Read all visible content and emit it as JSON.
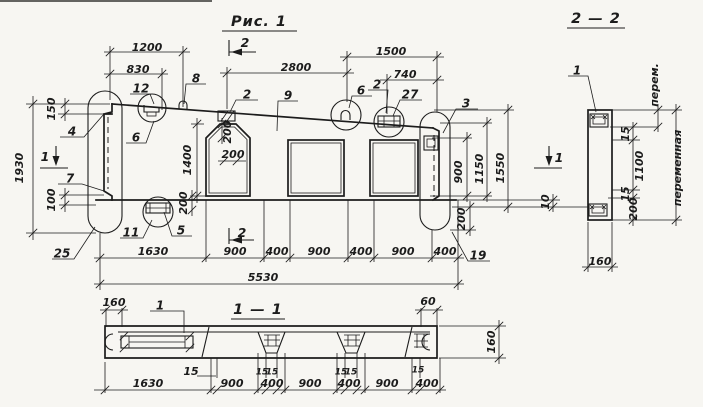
{
  "colors": {
    "paper": "#f7f6f2",
    "ink": "#1c1c1c"
  },
  "titles": {
    "figure": "Рис. 1",
    "section_2_2": "2 — 2",
    "section_1_1": "1 — 1"
  },
  "markers": {
    "cut_2_top": "2",
    "cut_2_bottom": "2",
    "cut_1_left": "1",
    "cut_1_right": "1"
  },
  "labels": [
    {
      "name": "dim-1200",
      "text": "1200",
      "x": 147,
      "y": 48,
      "rot": 0,
      "kind": "dim"
    },
    {
      "name": "dim-830",
      "text": "830",
      "x": 138,
      "y": 70,
      "rot": 0,
      "kind": "dim"
    },
    {
      "name": "callout-12",
      "text": "12",
      "x": 141,
      "y": 89,
      "rot": 0,
      "kind": "callout"
    },
    {
      "name": "callout-8",
      "text": "8",
      "x": 196,
      "y": 79,
      "rot": 0,
      "kind": "callout"
    },
    {
      "name": "dim-2800",
      "text": "2800",
      "x": 296,
      "y": 68,
      "rot": 0,
      "kind": "dim"
    },
    {
      "name": "dim-1500",
      "text": "1500",
      "x": 391,
      "y": 52,
      "rot": 0,
      "kind": "dim"
    },
    {
      "name": "dim-740",
      "text": "740",
      "x": 405,
      "y": 75,
      "rot": 0,
      "kind": "dim"
    },
    {
      "name": "callout-2-center",
      "text": "2",
      "x": 247,
      "y": 95,
      "rot": 0,
      "kind": "callout"
    },
    {
      "name": "callout-9",
      "text": "9",
      "x": 288,
      "y": 96,
      "rot": 0,
      "kind": "callout"
    },
    {
      "name": "callout-6-right",
      "text": "6",
      "x": 361,
      "y": 91,
      "rot": 0,
      "kind": "callout"
    },
    {
      "name": "callout-2-right",
      "text": "2",
      "x": 377,
      "y": 85,
      "rot": 0,
      "kind": "callout"
    },
    {
      "name": "callout-27",
      "text": "27",
      "x": 410,
      "y": 95,
      "rot": 0,
      "kind": "callout"
    },
    {
      "name": "callout-3",
      "text": "3",
      "x": 466,
      "y": 104,
      "rot": 0,
      "kind": "callout"
    },
    {
      "name": "callout-4",
      "text": "4",
      "x": 72,
      "y": 132,
      "rot": 0,
      "kind": "callout"
    },
    {
      "name": "callout-6-left",
      "text": "6",
      "x": 136,
      "y": 138,
      "rot": 0,
      "kind": "callout"
    },
    {
      "name": "callout-7",
      "text": "7",
      "x": 70,
      "y": 179,
      "rot": 0,
      "kind": "callout"
    },
    {
      "name": "callout-11",
      "text": "11",
      "x": 131,
      "y": 233,
      "rot": 0,
      "kind": "callout"
    },
    {
      "name": "callout-5",
      "text": "5",
      "x": 181,
      "y": 231,
      "rot": 0,
      "kind": "callout"
    },
    {
      "name": "callout-25",
      "text": "25",
      "x": 62,
      "y": 254,
      "rot": 0,
      "kind": "callout"
    },
    {
      "name": "callout-19",
      "text": "19",
      "x": 478,
      "y": 256,
      "rot": 0,
      "kind": "callout"
    },
    {
      "name": "dim-1930",
      "text": "1930",
      "x": 20,
      "y": 168,
      "rot": -90,
      "kind": "dim"
    },
    {
      "name": "dim-150",
      "text": "150",
      "x": 52,
      "y": 109,
      "rot": -90,
      "kind": "dim"
    },
    {
      "name": "dim-100",
      "text": "100",
      "x": 52,
      "y": 200,
      "rot": -90,
      "kind": "dim"
    },
    {
      "name": "dim-1400",
      "text": "1400",
      "x": 188,
      "y": 160,
      "rot": -90,
      "kind": "dim"
    },
    {
      "name": "dim-200-chamfer-v",
      "text": "200",
      "x": 228,
      "y": 132,
      "rot": -90,
      "kind": "dim"
    },
    {
      "name": "dim-200-chamfer-h",
      "text": "200",
      "x": 233,
      "y": 155,
      "rot": 0,
      "kind": "dim"
    },
    {
      "name": "dim-200-left-notch",
      "text": "200",
      "x": 184,
      "y": 203,
      "rot": -90,
      "kind": "dim"
    },
    {
      "name": "dim-200-right-end",
      "text": "200",
      "x": 462,
      "y": 219,
      "rot": -90,
      "kind": "dim"
    },
    {
      "name": "dim-900-right",
      "text": "900",
      "x": 459,
      "y": 172,
      "rot": -90,
      "kind": "dim"
    },
    {
      "name": "dim-1150",
      "text": "1150",
      "x": 480,
      "y": 169,
      "rot": -90,
      "kind": "dim"
    },
    {
      "name": "dim-1550",
      "text": "1550",
      "x": 501,
      "y": 168,
      "rot": -90,
      "kind": "dim"
    },
    {
      "name": "dim-10",
      "text": "10",
      "x": 546,
      "y": 202,
      "rot": -90,
      "kind": "dim"
    },
    {
      "name": "dim-1630",
      "text": "1630",
      "x": 153,
      "y": 252,
      "rot": 0,
      "kind": "dim"
    },
    {
      "name": "dim-900-a",
      "text": "900",
      "x": 235,
      "y": 252,
      "rot": 0,
      "kind": "dim"
    },
    {
      "name": "dim-400-a",
      "text": "400",
      "x": 277,
      "y": 252,
      "rot": 0,
      "kind": "dim"
    },
    {
      "name": "dim-900-b",
      "text": "900",
      "x": 319,
      "y": 252,
      "rot": 0,
      "kind": "dim"
    },
    {
      "name": "dim-400-b",
      "text": "400",
      "x": 361,
      "y": 252,
      "rot": 0,
      "kind": "dim"
    },
    {
      "name": "dim-900-c",
      "text": "900",
      "x": 403,
      "y": 252,
      "rot": 0,
      "kind": "dim"
    },
    {
      "name": "dim-400-c",
      "text": "400",
      "x": 445,
      "y": 252,
      "rot": 0,
      "kind": "dim"
    },
    {
      "name": "dim-5530",
      "text": "5530",
      "x": 263,
      "y": 278,
      "rot": 0,
      "kind": "dim"
    },
    {
      "name": "callout-1-s22",
      "text": "1",
      "x": 577,
      "y": 71,
      "rot": 0,
      "kind": "callout"
    },
    {
      "name": "dim-perem",
      "text": "перем.",
      "x": 655,
      "y": 85,
      "rot": -90,
      "kind": "dim"
    },
    {
      "name": "dim-15-s22-top",
      "text": "15",
      "x": 626,
      "y": 134,
      "rot": -90,
      "kind": "dim"
    },
    {
      "name": "dim-1100",
      "text": "1100",
      "x": 640,
      "y": 166,
      "rot": -90,
      "kind": "dim"
    },
    {
      "name": "dim-15-s22-bot",
      "text": "15",
      "x": 626,
      "y": 194,
      "rot": -90,
      "kind": "dim"
    },
    {
      "name": "dim-200-s22",
      "text": "200",
      "x": 634,
      "y": 209,
      "rot": -90,
      "kind": "dim"
    },
    {
      "name": "dim-peremennaya",
      "text": "переменная",
      "x": 678,
      "y": 168,
      "rot": -90,
      "kind": "dim"
    },
    {
      "name": "dim-160-s22",
      "text": "160",
      "x": 600,
      "y": 262,
      "rot": 0,
      "kind": "dim"
    },
    {
      "name": "dim-160-s11-left",
      "text": "160",
      "x": 114,
      "y": 303,
      "rot": 0,
      "kind": "dim"
    },
    {
      "name": "callout-1-s11",
      "text": "1",
      "x": 160,
      "y": 306,
      "rot": 0,
      "kind": "callout"
    },
    {
      "name": "dim-15-s11",
      "text": "15",
      "x": 191,
      "y": 372,
      "rot": 0,
      "kind": "dim"
    },
    {
      "name": "dim-60",
      "text": "60",
      "x": 428,
      "y": 302,
      "rot": 0,
      "kind": "dim"
    },
    {
      "name": "dim-160-s11-right",
      "text": "160",
      "x": 492,
      "y": 342,
      "rot": -90,
      "kind": "dim"
    },
    {
      "name": "dim-15-p1a",
      "text": "15",
      "x": 262,
      "y": 372,
      "rot": 0,
      "kind": "small"
    },
    {
      "name": "dim-15-p1b",
      "text": "15",
      "x": 272,
      "y": 372,
      "rot": 0,
      "kind": "small"
    },
    {
      "name": "dim-15-p2a",
      "text": "15",
      "x": 341,
      "y": 372,
      "rot": 0,
      "kind": "small"
    },
    {
      "name": "dim-15-p2b",
      "text": "15",
      "x": 351,
      "y": 372,
      "rot": 0,
      "kind": "small"
    },
    {
      "name": "dim-15-p3",
      "text": "15",
      "x": 418,
      "y": 370,
      "rot": 0,
      "kind": "small"
    },
    {
      "name": "dim-1630-s11",
      "text": "1630",
      "x": 148,
      "y": 384,
      "rot": 0,
      "kind": "dim"
    },
    {
      "name": "dim-900-s11-a",
      "text": "900",
      "x": 232,
      "y": 384,
      "rot": 0,
      "kind": "dim"
    },
    {
      "name": "dim-400-s11-a",
      "text": "400",
      "x": 272,
      "y": 384,
      "rot": 0,
      "kind": "dim"
    },
    {
      "name": "dim-900-s11-b",
      "text": "900",
      "x": 310,
      "y": 384,
      "rot": 0,
      "kind": "dim"
    },
    {
      "name": "dim-400-s11-b",
      "text": "400",
      "x": 349,
      "y": 384,
      "rot": 0,
      "kind": "dim"
    },
    {
      "name": "dim-900-s11-c",
      "text": "900",
      "x": 387,
      "y": 384,
      "rot": 0,
      "kind": "dim"
    },
    {
      "name": "dim-400-s11-c",
      "text": "400",
      "x": 427,
      "y": 384,
      "rot": 0,
      "kind": "dim"
    }
  ]
}
